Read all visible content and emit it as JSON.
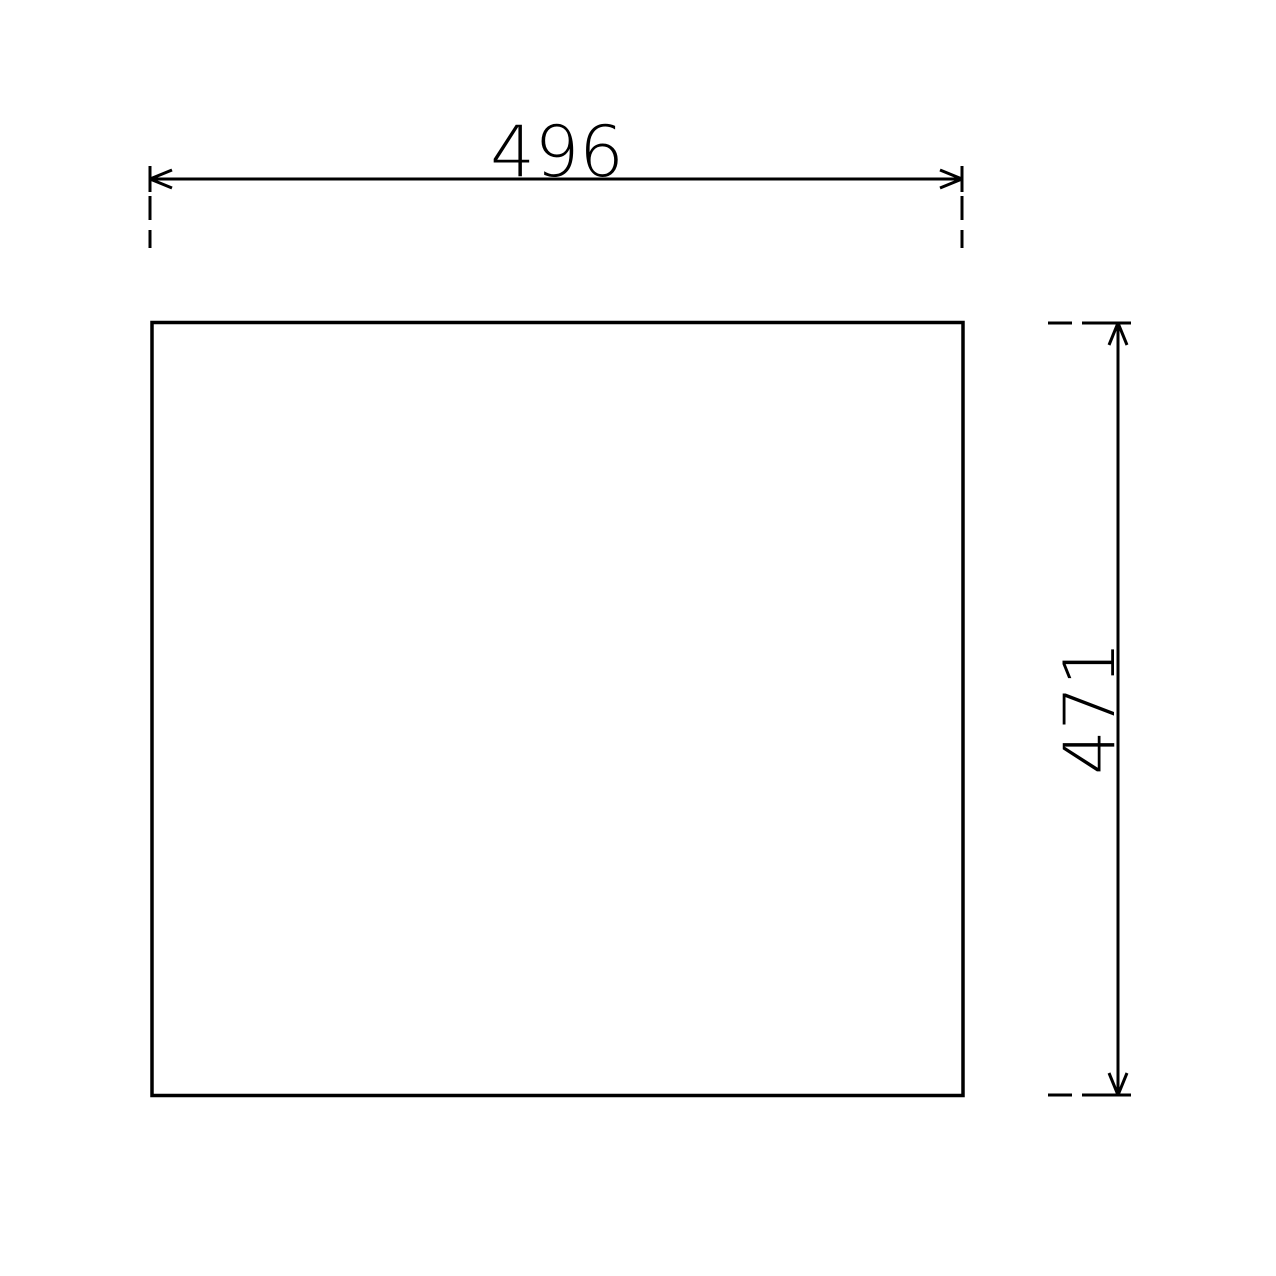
{
  "drawing": {
    "background_color": "#ffffff",
    "line_color": "#000000",
    "width_dimension": {
      "label": "496"
    },
    "height_dimension": {
      "label": "471"
    }
  }
}
